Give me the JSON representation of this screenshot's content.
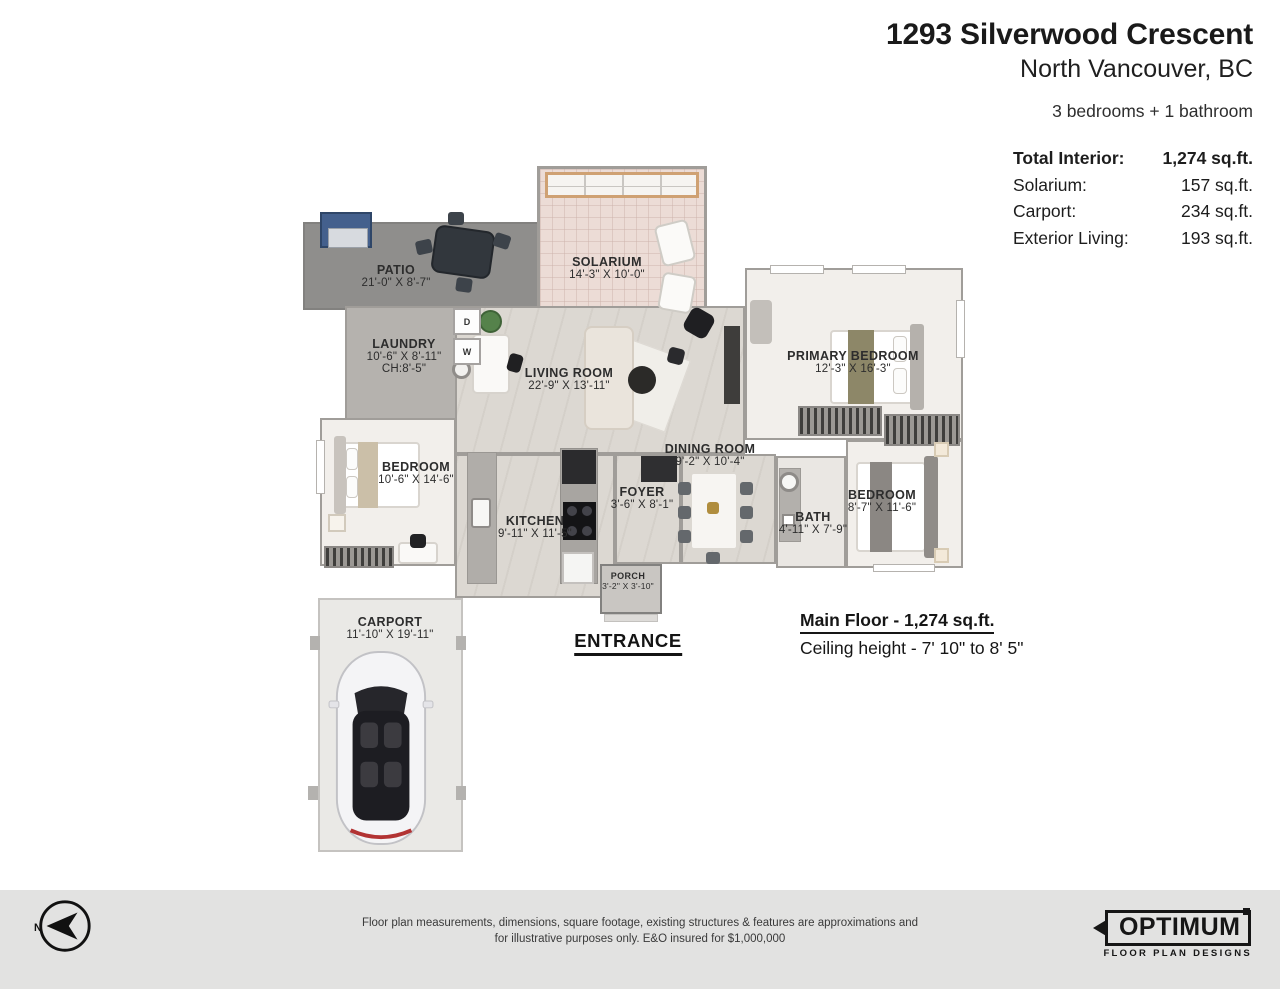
{
  "header": {
    "title": "1293 Silverwood Crescent",
    "subtitle": "North Vancouver, BC",
    "summary": "3 bedrooms + 1 bathroom",
    "stats": [
      {
        "label": "Total Interior:",
        "value": "1,274 sq.ft."
      },
      {
        "label": "Solarium:",
        "value": "157 sq.ft."
      },
      {
        "label": "Carport:",
        "value": "234 sq.ft."
      },
      {
        "label": "Exterior Living:",
        "value": "193 sq.ft."
      }
    ]
  },
  "rooms": [
    {
      "name": "PATIO",
      "dims": "21'-0\" X 8'-7\""
    },
    {
      "name": "SOLARIUM",
      "dims": "14'-3\" X 10'-0\""
    },
    {
      "name": "LAUNDRY",
      "dims": "10'-6\" X 8'-11\"",
      "extra": "CH:8'-5\""
    },
    {
      "name": "LIVING ROOM",
      "dims": "22'-9\" X 13'-11\""
    },
    {
      "name": "PRIMARY BEDROOM",
      "dims": "12'-3\" X 16'-3\""
    },
    {
      "name": "BEDROOM",
      "dims": "10'-6\" X 14'-6\""
    },
    {
      "name": "KITCHEN",
      "dims": "9'-11\" X 11'-5\""
    },
    {
      "name": "FOYER",
      "dims": "3'-6\" X 8'-1\""
    },
    {
      "name": "DINING ROOM",
      "dims": "9'-2\" X 10'-4\""
    },
    {
      "name": "BATH",
      "dims": "4'-11\" X 7'-9\""
    },
    {
      "name": "BEDROOM",
      "dims": "8'-7\" X 11'-6\""
    },
    {
      "name": "PORCH",
      "dims": "3'-2\" X 3'-10\""
    },
    {
      "name": "CARPORT",
      "dims": "11'-10\" X 19'-11\""
    }
  ],
  "appliances": {
    "dryer": "D",
    "washer": "W"
  },
  "floor_info": {
    "entrance": "ENTRANCE",
    "main_floor": "Main Floor - 1,274 sq.ft.",
    "ceiling": "Ceiling height - 7' 10\" to 8' 5\""
  },
  "footer": {
    "north_label": "N",
    "disclaimer_line1": "Floor plan measurements, dimensions, square footage, existing structures & features are approximations and",
    "disclaimer_line2": "for illustrative purposes only.  E&O insured for $1,000,000",
    "logo": {
      "name": "OPTIMUM",
      "tagline": "FLOOR PLAN DESIGNS"
    }
  },
  "colors": {
    "wall": "#a09d99",
    "wood_floor": "#dcd8d2",
    "carpet_floor": "#f2efeb",
    "patio_floor": "#8f8e8c",
    "solarium_floor": "#ecdcd6",
    "laundry_floor": "#b5b2ae",
    "carport_floor": "#eae9e6",
    "footer_bar": "#e2e2e1",
    "text": "#1b1b1b"
  }
}
